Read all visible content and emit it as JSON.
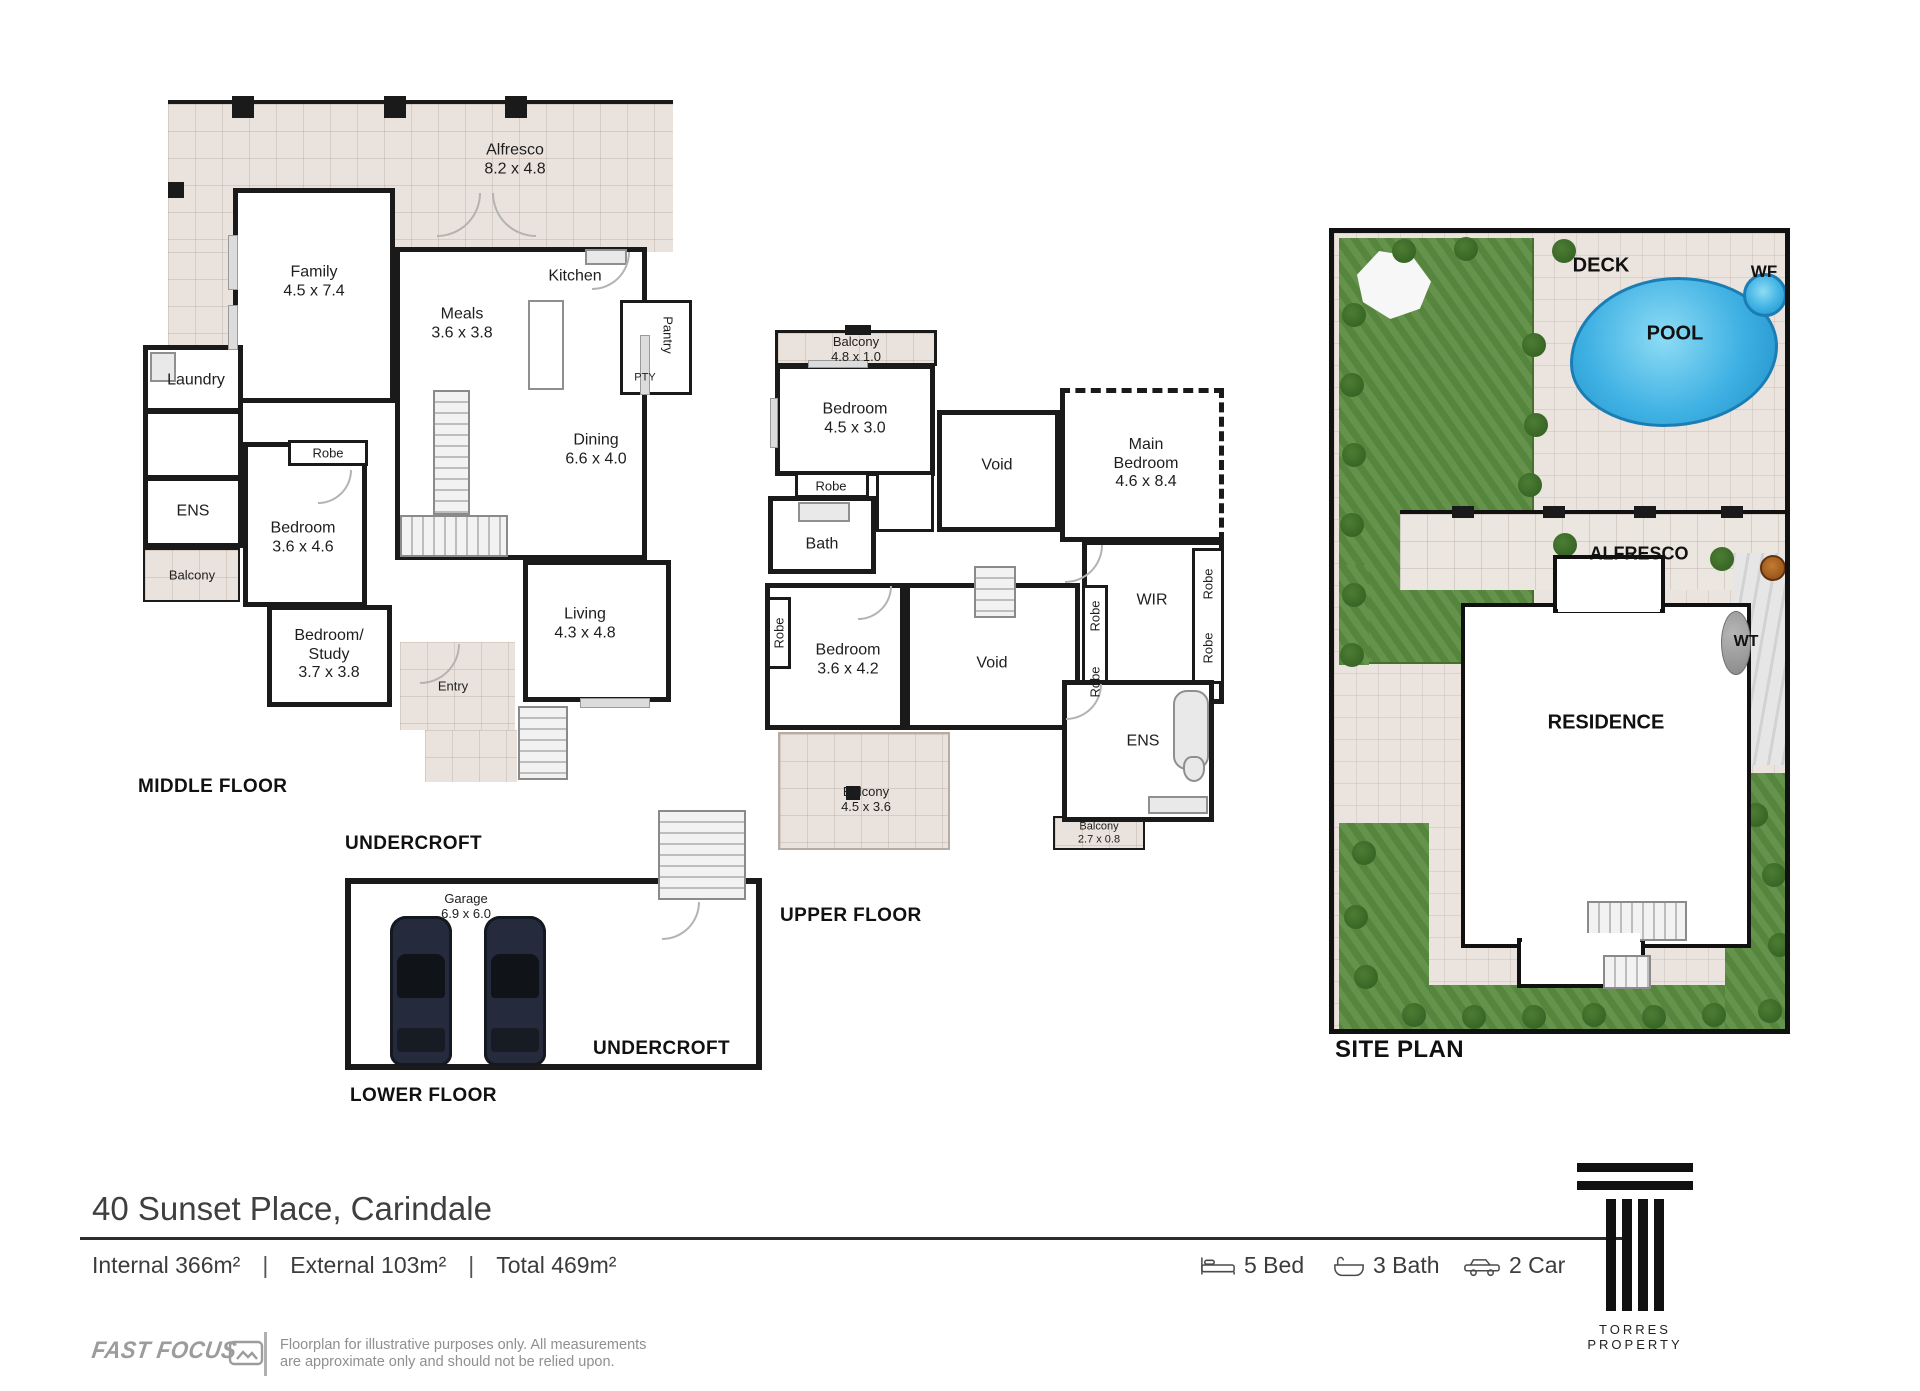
{
  "middle": {
    "title": "MIDDLE FLOOR",
    "alfresco_name": "Alfresco",
    "alfresco_dims": "8.2 x 4.8",
    "family_name": "Family",
    "family_dims": "4.5 x 7.4",
    "kitchen_name": "Kitchen",
    "meals_name": "Meals",
    "meals_dims": "3.6 x 3.8",
    "pty_name": "PTY",
    "pantry_name": "Pantry",
    "laundry_name": "Laundry",
    "dining_name": "Dining",
    "dining_dims": "6.6 x 4.0",
    "robe_name": "Robe",
    "ens_name": "ENS",
    "bedroom_name": "Bedroom",
    "bedroom_dims": "3.6 x 4.6",
    "balcony_name": "Balcony",
    "study_name1": "Bedroom/",
    "study_name2": "Study",
    "study_dims": "3.7 x 3.8",
    "living_name": "Living",
    "living_dims": "4.3 x 4.8",
    "entry_name": "Entry"
  },
  "upper": {
    "title": "UPPER FLOOR",
    "balcony_top_name": "Balcony",
    "balcony_top_dims": "4.8 x 1.0",
    "bedroom1_name": "Bedroom",
    "bedroom1_dims": "4.5 x 3.0",
    "robe": "Robe",
    "bath_name": "Bath",
    "void_top": "Void",
    "main_bedroom_name": "Main Bedroom",
    "main_bedroom_dims": "4.6 x 8.4",
    "wir_name": "WIR",
    "bedroom2_name": "Bedroom",
    "bedroom2_dims": "3.6 x 4.2",
    "void_bottom": "Void",
    "ens_name": "ENS",
    "balcony_big_name": "Balcony",
    "balcony_big_dims": "4.5 x 3.6",
    "balcony_small_name": "Balcony",
    "balcony_small_dims": "2.7 x 0.8"
  },
  "lower": {
    "title": "LOWER FLOOR",
    "undercroft_top": "UNDERCROFT",
    "undercroft_bottom": "UNDERCROFT",
    "garage_name": "Garage",
    "garage_dims": "6.9 x 6.0"
  },
  "site": {
    "title": "SITE PLAN",
    "deck": "DECK",
    "wf": "WF",
    "pool": "POOL",
    "alfresco": "ALFRESCO",
    "wt": "WT",
    "residence": "RESIDENCE"
  },
  "footer": {
    "address": "40 Sunset Place, Carindale",
    "area_internal": "Internal 366m²",
    "area_external": "External 103m²",
    "area_total": "Total 469m²",
    "divider": "|",
    "stat_bed": "5 Bed",
    "stat_bath": "3 Bath",
    "stat_car": "2 Car",
    "brand_name": "TORRES PROPERTY",
    "provider_name": "FAST FOCUS",
    "disclaimer_line1": "Floorplan for illustrative purposes only. All measurements",
    "disclaimer_line2": "are approximate only and should not be relied upon."
  },
  "colors": {
    "wall": "#1a1a1a",
    "tile": "#eae3dd",
    "lawn": "#5d8d43",
    "pool_blue": "#3fb1e3",
    "brand_gray": "#9c9c9c"
  }
}
